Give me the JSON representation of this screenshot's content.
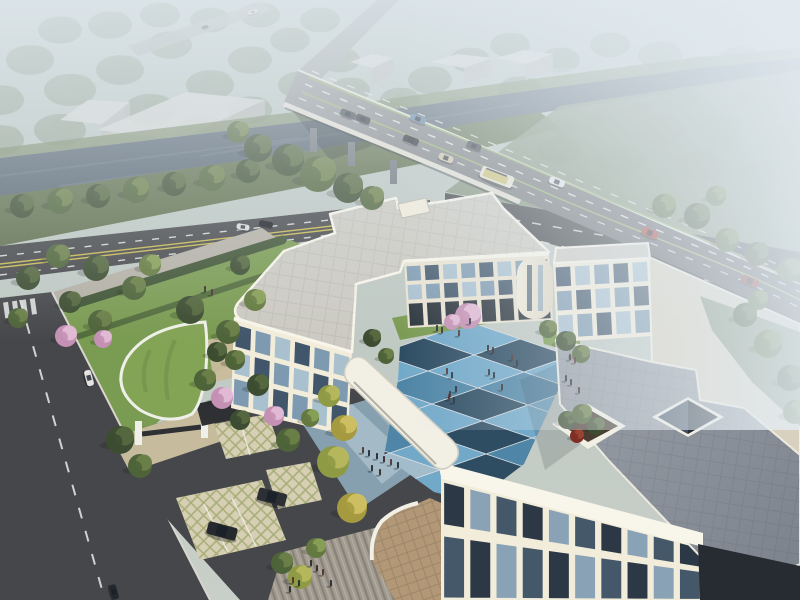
{
  "scene": {
    "type": "architectural-aerial-rendering",
    "elements": [
      "hazy-forest-background",
      "distant-warehouses",
      "elevated-highway-bridge",
      "river-canal",
      "riverside-road",
      "tree-lined-street",
      "cream-office-building-complex",
      "blue-checkerboard-courtyard",
      "pedestrians",
      "green-roof-gatehouse",
      "grass-grid-parking",
      "roof-terrace-planter",
      "atrium-skylight",
      "entrance-plaza-steps",
      "covered-walkway"
    ]
  },
  "palette": {
    "sky_top": "#b6c2bd",
    "sky_bottom": "#c8cfc8",
    "haze": "#e4ecf2",
    "river": "#55636f",
    "river_light": "#7b8894",
    "bank_far": "#768661",
    "bank_near": "#5e6f4b",
    "bank_right": "#7e8d74",
    "asphalt": "#46474a",
    "asphalt_dark": "#3e4043",
    "deck_light": "#909294",
    "deck_dark": "#4a4c4f",
    "approach": "#9da2a2",
    "line_white": "#e9ebe8",
    "line_yellow": "#c7b84e",
    "line_green": "#93b069",
    "curb": "#d8d6cf",
    "sidewalk": "#b4b0a5",
    "lawn": "#7a9b52",
    "lawn_dark": "#617e41",
    "hedge": "#3f5434",
    "roof_gray": "#cccac2",
    "roof_beige": "#d8d1bf",
    "terrace": "#9ba1a9",
    "terrace_dark": "#7a818b",
    "parapet": "#f8f5ea",
    "wall_bright": "#f2ecda",
    "wall_mid": "#eae3d1",
    "wall_shade": "#ded6c3",
    "arcade": "#2a323b",
    "court_light": "#72a9c9",
    "court_mid": "#4f85a6",
    "court_dark": "#2e4d63",
    "court_pale": "#a3bccb",
    "plaza_a": "#a4bac6",
    "plaza_b": "#86a0b0",
    "path": "#b1afa8",
    "steps": "#a29b90",
    "plaza_tan": "#b29877",
    "lattice_base": "#d6cfb4",
    "lattice_line": "#a8ad7a",
    "paver_tan": "#c7bb9e",
    "green_roof": "#83a355",
    "canopy": "#f2efe4",
    "gate_dark": "#2e3034",
    "pillar": "#f0f0ea",
    "skylight": "#232d38",
    "skylight_glass": "#46586a",
    "planter_soil": "#4a3c30",
    "people": "#23262b",
    "box_top": "#d3d5d1",
    "box_front": "#b8bab6",
    "distant_road": "#a9aeaa",
    "dark_corner": "#272c32",
    "glass": {
      "a": "#41566b",
      "b": "#7e9ab0",
      "c": "#a9c0cf",
      "da": "#2c3845",
      "db": "#45586a",
      "dc": "#8aa2b5"
    },
    "tree_kinds": {
      "dark": [
        "#3c4d31",
        "#55683f"
      ],
      "mid": [
        "#4e6339",
        "#6b7f48"
      ],
      "light": [
        "#64793f",
        "#88a057"
      ],
      "yellow": [
        "#8f9a45",
        "#b8b85f"
      ],
      "autumn": [
        "#a59a3f",
        "#cfc063"
      ],
      "pink": [
        "#c490b4",
        "#e3bcd6"
      ],
      "red": [
        "#7e2f24",
        "#9c4533"
      ],
      "distant": [
        "#7d8c76",
        "#95a28c"
      ]
    }
  },
  "entities": {
    "trees": [
      [
        22,
        206,
        12,
        "dark"
      ],
      [
        60,
        201,
        13,
        "mid"
      ],
      [
        98,
        196,
        12,
        "dark"
      ],
      [
        136,
        190,
        13,
        "mid"
      ],
      [
        174,
        184,
        12,
        "dark"
      ],
      [
        212,
        178,
        13,
        "mid"
      ],
      [
        248,
        171,
        12,
        "dark"
      ],
      [
        258,
        148,
        14,
        "dark"
      ],
      [
        288,
        160,
        16,
        "dark"
      ],
      [
        318,
        174,
        18,
        "mid"
      ],
      [
        348,
        188,
        15,
        "dark"
      ],
      [
        372,
        198,
        12,
        "mid"
      ],
      [
        238,
        132,
        11,
        "mid"
      ],
      [
        664,
        206,
        12,
        "mid"
      ],
      [
        697,
        216,
        13,
        "dark"
      ],
      [
        727,
        240,
        12,
        "mid"
      ],
      [
        757,
        254,
        12,
        "dark"
      ],
      [
        789,
        270,
        12,
        "mid"
      ],
      [
        716,
        196,
        10,
        "mid"
      ],
      [
        745,
        315,
        12,
        "dark"
      ],
      [
        768,
        344,
        14,
        "mid"
      ],
      [
        790,
        378,
        13,
        "dark"
      ],
      [
        758,
        300,
        10,
        "mid"
      ],
      [
        795,
        412,
        12,
        "mid"
      ],
      [
        58,
        256,
        12,
        "mid"
      ],
      [
        96,
        268,
        13,
        "dark"
      ],
      [
        134,
        288,
        12,
        "mid"
      ],
      [
        70,
        302,
        11,
        "dark"
      ],
      [
        100,
        322,
        12,
        "mid"
      ],
      [
        150,
        265,
        11,
        "light"
      ],
      [
        190,
        310,
        14,
        "dark"
      ],
      [
        228,
        332,
        12,
        "mid"
      ],
      [
        255,
        300,
        11,
        "light"
      ],
      [
        28,
        278,
        12,
        "dark"
      ],
      [
        18,
        318,
        10,
        "mid"
      ],
      [
        240,
        265,
        10,
        "dark"
      ],
      [
        66,
        336,
        11,
        "pink"
      ],
      [
        103,
        339,
        9,
        "pink"
      ],
      [
        222,
        398,
        11,
        "pink"
      ],
      [
        274,
        416,
        10,
        "pink"
      ],
      [
        468,
        316,
        13,
        "pink"
      ],
      [
        452,
        322,
        8,
        "pink"
      ],
      [
        217,
        352,
        10,
        "dark"
      ],
      [
        205,
        380,
        11,
        "mid"
      ],
      [
        240,
        420,
        10,
        "dark"
      ],
      [
        548,
        329,
        9,
        "mid"
      ],
      [
        566,
        341,
        10,
        "dark"
      ],
      [
        581,
        354,
        9,
        "mid"
      ],
      [
        372,
        338,
        9,
        "dark"
      ],
      [
        386,
        356,
        8,
        "mid"
      ],
      [
        329,
        396,
        11,
        "yellow"
      ],
      [
        344,
        428,
        13,
        "autumn"
      ],
      [
        333,
        462,
        16,
        "yellow"
      ],
      [
        352,
        508,
        15,
        "autumn"
      ],
      [
        300,
        577,
        12,
        "yellow"
      ],
      [
        316,
        548,
        10,
        "light"
      ],
      [
        235,
        360,
        10,
        "mid"
      ],
      [
        258,
        385,
        11,
        "dark"
      ],
      [
        288,
        440,
        12,
        "mid"
      ],
      [
        310,
        418,
        9,
        "light"
      ],
      [
        120,
        440,
        14,
        "dark"
      ],
      [
        140,
        466,
        12,
        "mid"
      ],
      [
        567,
        420,
        9,
        "dark"
      ],
      [
        582,
        414,
        10,
        "mid"
      ],
      [
        596,
        426,
        9,
        "dark"
      ],
      [
        577,
        436,
        7,
        "red"
      ],
      [
        282,
        563,
        11,
        "mid"
      ]
    ],
    "distant_trees": [
      [
        30,
        60,
        24
      ],
      [
        70,
        90,
        26
      ],
      [
        120,
        70,
        24
      ],
      [
        170,
        45,
        22
      ],
      [
        60,
        130,
        26
      ],
      [
        150,
        110,
        26
      ],
      [
        210,
        85,
        24
      ],
      [
        250,
        60,
        22
      ],
      [
        200,
        130,
        24
      ],
      [
        290,
        40,
        20
      ],
      [
        320,
        20,
        20
      ],
      [
        100,
        160,
        24
      ],
      [
        40,
        170,
        22
      ],
      [
        250,
        110,
        22
      ],
      [
        300,
        85,
        22
      ],
      [
        340,
        60,
        20
      ],
      [
        230,
        150,
        22
      ],
      [
        430,
        80,
        22
      ],
      [
        470,
        60,
        20
      ],
      [
        510,
        45,
        20
      ],
      [
        460,
        110,
        22
      ],
      [
        520,
        90,
        22
      ],
      [
        560,
        60,
        20
      ],
      [
        610,
        45,
        20
      ],
      [
        660,
        55,
        22
      ],
      [
        700,
        70,
        22
      ],
      [
        740,
        60,
        22
      ],
      [
        780,
        75,
        22
      ],
      [
        600,
        90,
        22
      ],
      [
        680,
        95,
        22
      ],
      [
        760,
        100,
        24
      ],
      [
        660,
        130,
        24
      ],
      [
        720,
        130,
        24
      ],
      [
        780,
        140,
        24
      ],
      [
        560,
        150,
        22
      ],
      [
        620,
        160,
        24
      ],
      [
        700,
        165,
        24
      ],
      [
        760,
        175,
        24
      ],
      [
        360,
        120,
        22
      ],
      [
        400,
        100,
        20
      ],
      [
        330,
        140,
        22
      ],
      [
        390,
        150,
        22
      ],
      [
        440,
        140,
        22
      ],
      [
        500,
        130,
        22
      ],
      [
        60,
        30,
        22
      ],
      [
        110,
        25,
        22
      ],
      [
        160,
        15,
        20
      ],
      [
        210,
        20,
        20
      ],
      [
        260,
        15,
        20
      ],
      [
        0,
        100,
        24
      ],
      [
        0,
        140,
        24
      ],
      [
        350,
        90,
        20
      ],
      [
        565,
        128,
        14
      ],
      [
        602,
        117,
        12
      ],
      [
        640,
        108,
        11
      ]
    ],
    "people": [
      [
        437,
        331
      ],
      [
        442,
        333
      ],
      [
        459,
        336
      ],
      [
        470,
        324
      ],
      [
        488,
        351
      ],
      [
        493,
        353
      ],
      [
        512,
        360
      ],
      [
        489,
        375
      ],
      [
        494,
        378
      ],
      [
        502,
        390
      ],
      [
        449,
        400
      ],
      [
        454,
        403
      ],
      [
        517,
        366
      ],
      [
        570,
        360
      ],
      [
        575,
        363
      ],
      [
        566,
        381
      ],
      [
        571,
        385
      ],
      [
        579,
        393
      ],
      [
        363,
        453
      ],
      [
        369,
        456
      ],
      [
        377,
        459
      ],
      [
        384,
        462
      ],
      [
        391,
        465
      ],
      [
        398,
        468
      ],
      [
        372,
        471
      ],
      [
        380,
        475
      ],
      [
        447,
        374
      ],
      [
        452,
        378
      ],
      [
        456,
        392
      ],
      [
        450,
        397
      ],
      [
        293,
        583
      ],
      [
        299,
        586
      ],
      [
        311,
        566
      ],
      [
        317,
        571
      ],
      [
        323,
        575
      ],
      [
        331,
        586
      ],
      [
        290,
        592
      ],
      [
        205,
        292
      ],
      [
        212,
        295
      ]
    ],
    "cars": [
      [
        348,
        114,
        21,
        16,
        7,
        "#3a4046"
      ],
      [
        363,
        119,
        21,
        15,
        7,
        "#2b3036"
      ],
      [
        418,
        119,
        21,
        16,
        7,
        "#5d7f9d"
      ],
      [
        411,
        140,
        21,
        16,
        7,
        "#23272c"
      ],
      [
        446,
        158,
        21,
        15,
        7,
        "#cfc5a8"
      ],
      [
        474,
        146,
        21,
        15,
        7,
        "#3c4248"
      ],
      [
        497,
        177,
        21,
        34,
        12,
        "bus"
      ],
      [
        557,
        182,
        21,
        16,
        7,
        "#e3e5e6"
      ],
      [
        650,
        233,
        22,
        17,
        8,
        "#a83a31"
      ],
      [
        750,
        281,
        23,
        18,
        8,
        "#8a2d27"
      ],
      [
        266,
        224,
        10,
        14,
        6,
        "#1a1d20"
      ],
      [
        243,
        227,
        10,
        13,
        6,
        "#d9dad8"
      ],
      [
        89,
        378,
        75,
        16,
        7,
        "#e4e5e3"
      ],
      [
        114,
        592,
        75,
        15,
        7,
        "#24272b"
      ],
      [
        222,
        531,
        15,
        30,
        13,
        "#26292d"
      ],
      [
        272,
        497,
        15,
        29,
        13,
        "#2c2f33"
      ],
      [
        253,
        12,
        -17,
        10,
        4,
        "#dcdcd2"
      ],
      [
        205,
        27,
        -17,
        7,
        3,
        "#5a5d5c"
      ]
    ],
    "distant_boxes": [
      {
        "top": "60,120 88,100 130,102 102,124",
        "front": "102,124 130,102 130,116 102,140"
      },
      {
        "top": "98,130 186,92 265,100 178,140",
        "front": "178,140 265,100 265,114 178,156"
      },
      {
        "top": "350,62 372,54 394,58 372,68",
        "front": "372,68 394,58 394,74 372,84"
      },
      {
        "top": "430,62 458,54 492,58 464,68",
        "front": "464,68 492,58 492,74 464,84"
      },
      {
        "top": "497,58 524,50 553,54 526,64",
        "front": "526,64 553,54 553,70 526,80"
      }
    ],
    "courtyard_tiles": {
      "origin": [
        470,
        322
      ],
      "u": [
        50,
        17
      ],
      "v": [
        -46,
        16
      ],
      "cols": 6,
      "rows": 6,
      "colors": [
        [
          "light",
          "dark",
          "light",
          "mid",
          "light",
          "dark"
        ],
        [
          "dark",
          "light",
          "mid",
          "light",
          "dark",
          "light"
        ],
        [
          "light",
          "mid",
          "dark",
          "light",
          "light",
          "mid"
        ],
        [
          "pale",
          "light",
          "light",
          "dark",
          "mid",
          "light"
        ],
        [
          "light",
          "dark",
          "mid",
          "light",
          "dark",
          "light"
        ],
        [
          "mid",
          "light",
          "dark",
          "pale",
          "light",
          "dark"
        ]
      ]
    },
    "bridge_piers": [
      [
        310,
        128
      ],
      [
        348,
        142
      ],
      [
        390,
        160
      ]
    ]
  }
}
